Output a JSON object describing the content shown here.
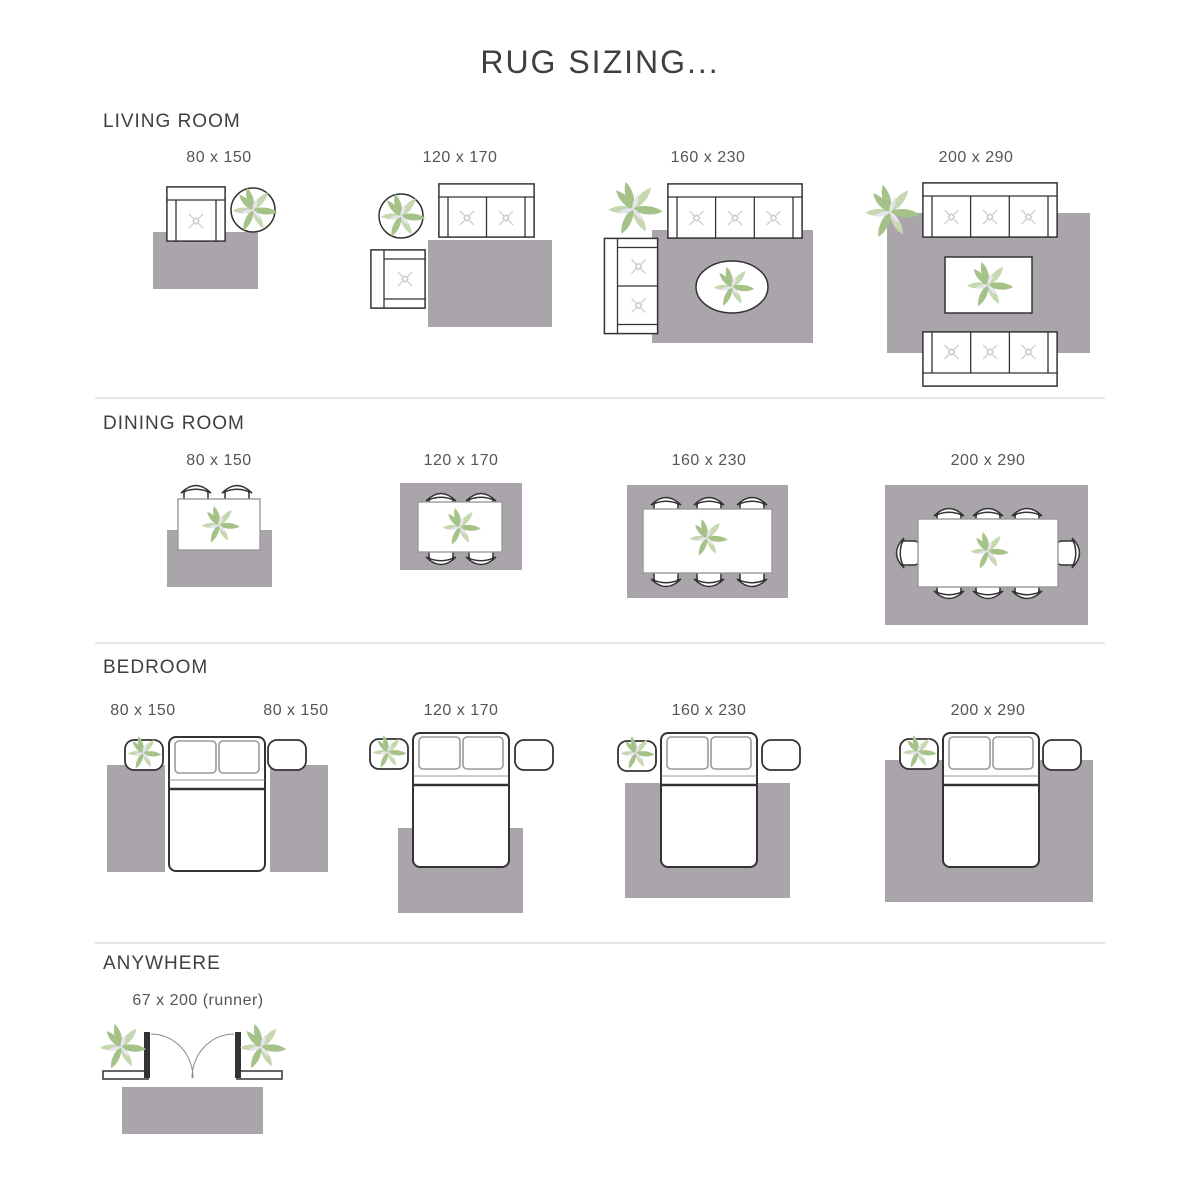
{
  "title": "RUG SIZING...",
  "sections": [
    {
      "heading": "LIVING ROOM",
      "items": [
        {
          "label": "80 x 150",
          "scene": "armchair and potted plant beside rug"
        },
        {
          "label": "120 x 170",
          "scene": "loveseat, armchair and potted plant around rug"
        },
        {
          "label": "160 x 230",
          "scene": "sofa, loveseat, oval coffee table on rug, plant"
        },
        {
          "label": "200 x 290",
          "scene": "two sofas facing coffee table on rug, plant"
        }
      ]
    },
    {
      "heading": "DINING ROOM",
      "items": [
        {
          "label": "80 x 150",
          "scene": "dining table with 2 chairs over rug"
        },
        {
          "label": "120 x 170",
          "scene": "dining table with 4 chairs on rug"
        },
        {
          "label": "160 x 230",
          "scene": "dining table with 6 chairs on rug"
        },
        {
          "label": "200 x 290",
          "scene": "dining table with 8 chairs on rug"
        }
      ]
    },
    {
      "heading": "BEDROOM",
      "items": [
        {
          "label": "80 x 150",
          "scene": "runner rug left of bed"
        },
        {
          "label": "80 x 150",
          "scene": "runner rug right of bed"
        },
        {
          "label": "120 x 170",
          "scene": "rug under foot of bed"
        },
        {
          "label": "160 x 230",
          "scene": "rug under lower two-thirds of bed"
        },
        {
          "label": "200 x 290",
          "scene": "rug under bed and nightstands"
        }
      ]
    },
    {
      "heading": "ANYWHERE",
      "items": [
        {
          "label": "67 x 200 (runner)",
          "scene": "runner rug inside double doors with plants"
        }
      ]
    }
  ],
  "icons": {
    "plant": "plant-icon",
    "potted_plant": "potted-plant-icon",
    "armchair": "armchair-icon",
    "loveseat": "loveseat-icon",
    "sofa": "sofa-icon",
    "dining_chair": "dining-chair-icon",
    "dining_table": "dining-table-icon",
    "coffee_table": "coffee-table-icon",
    "bed": "bed-icon",
    "nightstand": "nightstand-icon",
    "double_door": "double-door-icon",
    "rug": "rug-swatch"
  },
  "colors": {
    "bg": "#ffffff",
    "rug": "#a9a5ab",
    "outline": "#333333",
    "lite": "#9a9a9a",
    "tuft": "#c9c9c9",
    "g1": "#a5c289",
    "g2": "#c6d8b0",
    "g3": "#e7e4ef",
    "head": "#3f3f3f",
    "txt": "#555555",
    "div": "#cccccc"
  }
}
